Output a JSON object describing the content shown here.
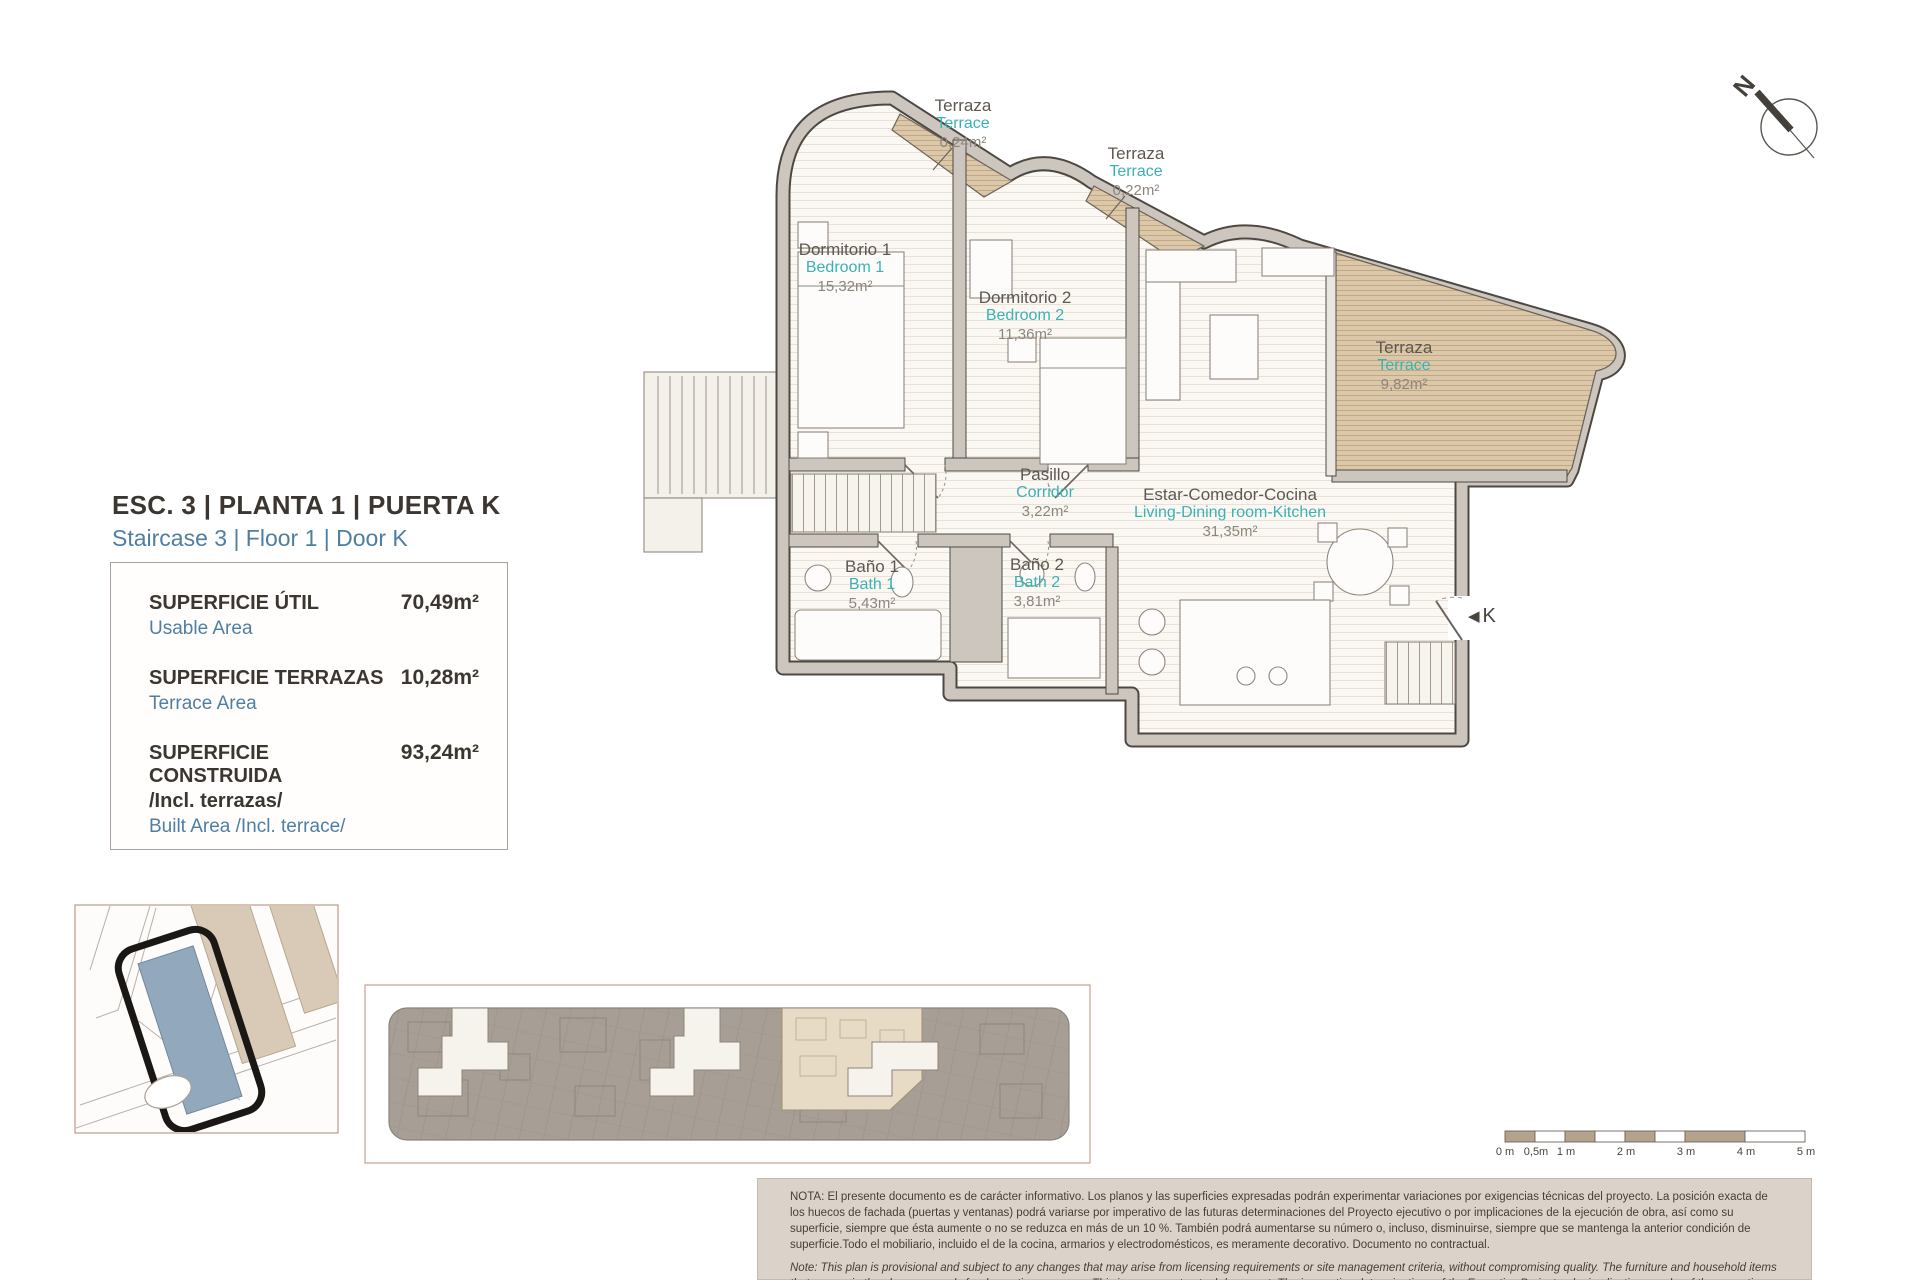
{
  "page": {
    "title_es": "ESC. 3 | PLANTA 1 | PUERTA K",
    "title_en": "Staircase 3 | Floor 1 | Door K"
  },
  "summary": {
    "rows": [
      {
        "label_es": "SUPERFICIE ÚTIL",
        "label_es2": "",
        "label_en": "Usable Area",
        "value": "70,49m²"
      },
      {
        "label_es": "SUPERFICIE TERRAZAS",
        "label_es2": "",
        "label_en": "Terrace Area",
        "value": "10,28m²"
      },
      {
        "label_es": "SUPERFICIE CONSTRUIDA",
        "label_es2": "/Incl. terrazas/",
        "label_en": "Built Area /Incl. terrace/",
        "value": "93,24m²"
      }
    ]
  },
  "rooms": [
    {
      "es": "Terraza",
      "en": "Terrace",
      "area": "0,24m²"
    },
    {
      "es": "Terraza",
      "en": "Terrace",
      "area": "0,22m²"
    },
    {
      "es": "Dormitorio 1",
      "en": "Bedroom 1",
      "area": "15,32m²"
    },
    {
      "es": "Dormitorio 2",
      "en": "Bedroom 2",
      "area": "11,36m²"
    },
    {
      "es": "Terraza",
      "en": "Terrace",
      "area": "9,82m²"
    },
    {
      "es": "Pasillo",
      "en": "Corridor",
      "area": "3,22m²"
    },
    {
      "es": "Baño 1",
      "en": "Bath 1",
      "area": "5,43m²"
    },
    {
      "es": "Baño 2",
      "en": "Bath 2",
      "area": "3,81m²"
    },
    {
      "es": "Estar-Comedor-Cocina",
      "en": "Living-Dining room-Kitchen",
      "area": "31,35m²"
    }
  ],
  "entry_door_label": "K",
  "compass_label": "N",
  "scale_bar": {
    "labels": [
      "0 m",
      "0,5m",
      "1 m",
      "2 m",
      "3 m",
      "4 m",
      "5 m"
    ]
  },
  "note": {
    "es": "NOTA:  El presente documento es de carácter informativo. Los planos y las superficies expresadas podrán experimentar variaciones por exigencias técnicas del proyecto. La posición exacta de los huecos de fachada (puertas y ventanas) podrá variarse por imperativo de las futuras determinaciones del Proyecto ejecutivo o por implicaciones de la ejecución de obra, así como su superficie, siempre que ésta aumente o no se reduzca en más de un 10 %. También podrá aumentarse su número o, incluso, disminuirse, siempre que se mantenga la anterior condición de superficie.Todo el mobiliario, incluido el de la cocina, armarios y electrodomésticos, es meramente decorativo. Documento no contractual.",
    "en": "Note: This plan is provisional and subject to any changes that may arise from licensing requirements or site management criteria, without compromising quality. The furniture and household items that appear in the plan are merely for decorative purposes. This is a non-contractual document. The imperative determinations of the Executive Project or by implications works of the execution, can change the exact position of the facade of doors and windows, as well the surface area may also be increased or even decrease not more than a 10%.",
    "version": "V.1_JUN-25"
  }
}
